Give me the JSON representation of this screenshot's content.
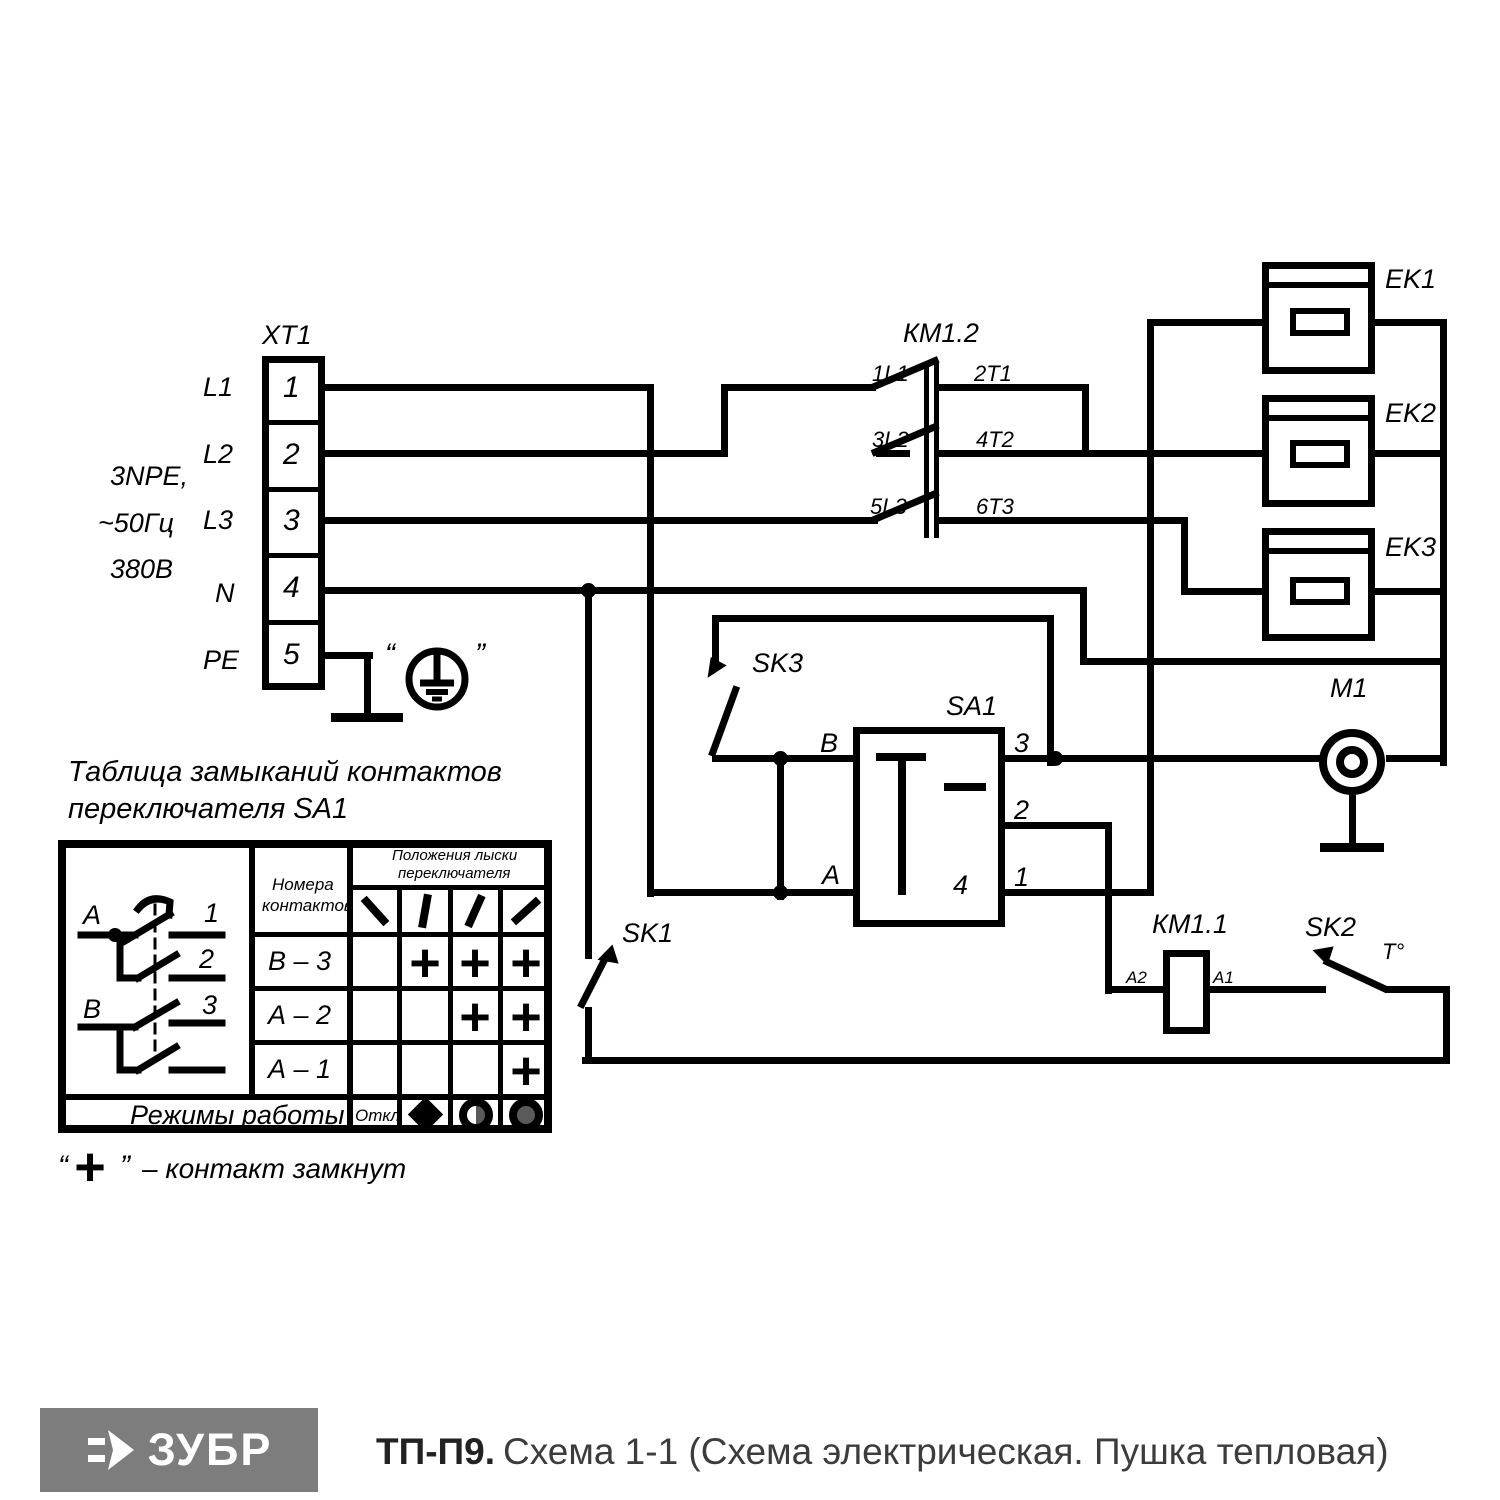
{
  "xt1": {
    "label": "XT1",
    "terminals": [
      "1",
      "2",
      "3",
      "4",
      "5"
    ],
    "lines": [
      "L1",
      "L2",
      "L3",
      "N",
      "PE"
    ],
    "supply": [
      "3NPE,",
      "~50Гц",
      "380В"
    ]
  },
  "km12": {
    "label": "КМ1.2",
    "c": [
      [
        "1L1",
        "2T1"
      ],
      [
        "3L2",
        "4T2"
      ],
      [
        "5L3",
        "6T3"
      ]
    ]
  },
  "heaters": [
    {
      "label": "EK1"
    },
    {
      "label": "EK2"
    },
    {
      "label": "EK3"
    }
  ],
  "motor": {
    "label": "M1"
  },
  "sa1": {
    "label": "SA1",
    "b": "В",
    "a": "А",
    "t3": "3",
    "t2": "2",
    "t1": "1",
    "t4": "4"
  },
  "sk1": {
    "label": "SK1"
  },
  "sk2": {
    "label": "SK2",
    "temp": "Т°"
  },
  "sk3": {
    "label": "SK3"
  },
  "km11": {
    "label": "КМ1.1",
    "a2": "А2",
    "a1": "А1"
  },
  "ground": {
    "quote_l": "“",
    "quote_r": "”"
  },
  "table": {
    "title_line1": "Таблица замыканий контактов",
    "title_line2": "переключателя SA1",
    "numbers_header_l1": "Номера",
    "numbers_header_l2": "контактов",
    "positions_header_l1": "Положения лыски",
    "positions_header_l2": "переключателя",
    "rows": [
      {
        "name": "В – 3",
        "marks": [
          "",
          "+",
          "+",
          "+"
        ]
      },
      {
        "name": "А – 2",
        "marks": [
          "",
          "",
          "+",
          "+"
        ]
      },
      {
        "name": "А – 1",
        "marks": [
          "",
          "",
          "",
          "+"
        ]
      }
    ],
    "modes_label": "Режимы работы",
    "off_label": "Откл",
    "mode_icons": [
      "off-text",
      "fan-diamond-icon",
      "half-heat-icon",
      "full-heat-icon"
    ],
    "diagram_labels": {
      "a": "А",
      "b": "В",
      "n1": "1",
      "n2": "2",
      "n3": "3"
    }
  },
  "legend": {
    "quote_open": "“",
    "plus": "+",
    "quote_close": "”",
    "text": "– контакт замкнут"
  },
  "footer": {
    "brand": "ЗУБР",
    "model": "ТП-П9.",
    "desc": "Схема 1-1 (Схема электрическая. Пушка тепловая)"
  }
}
